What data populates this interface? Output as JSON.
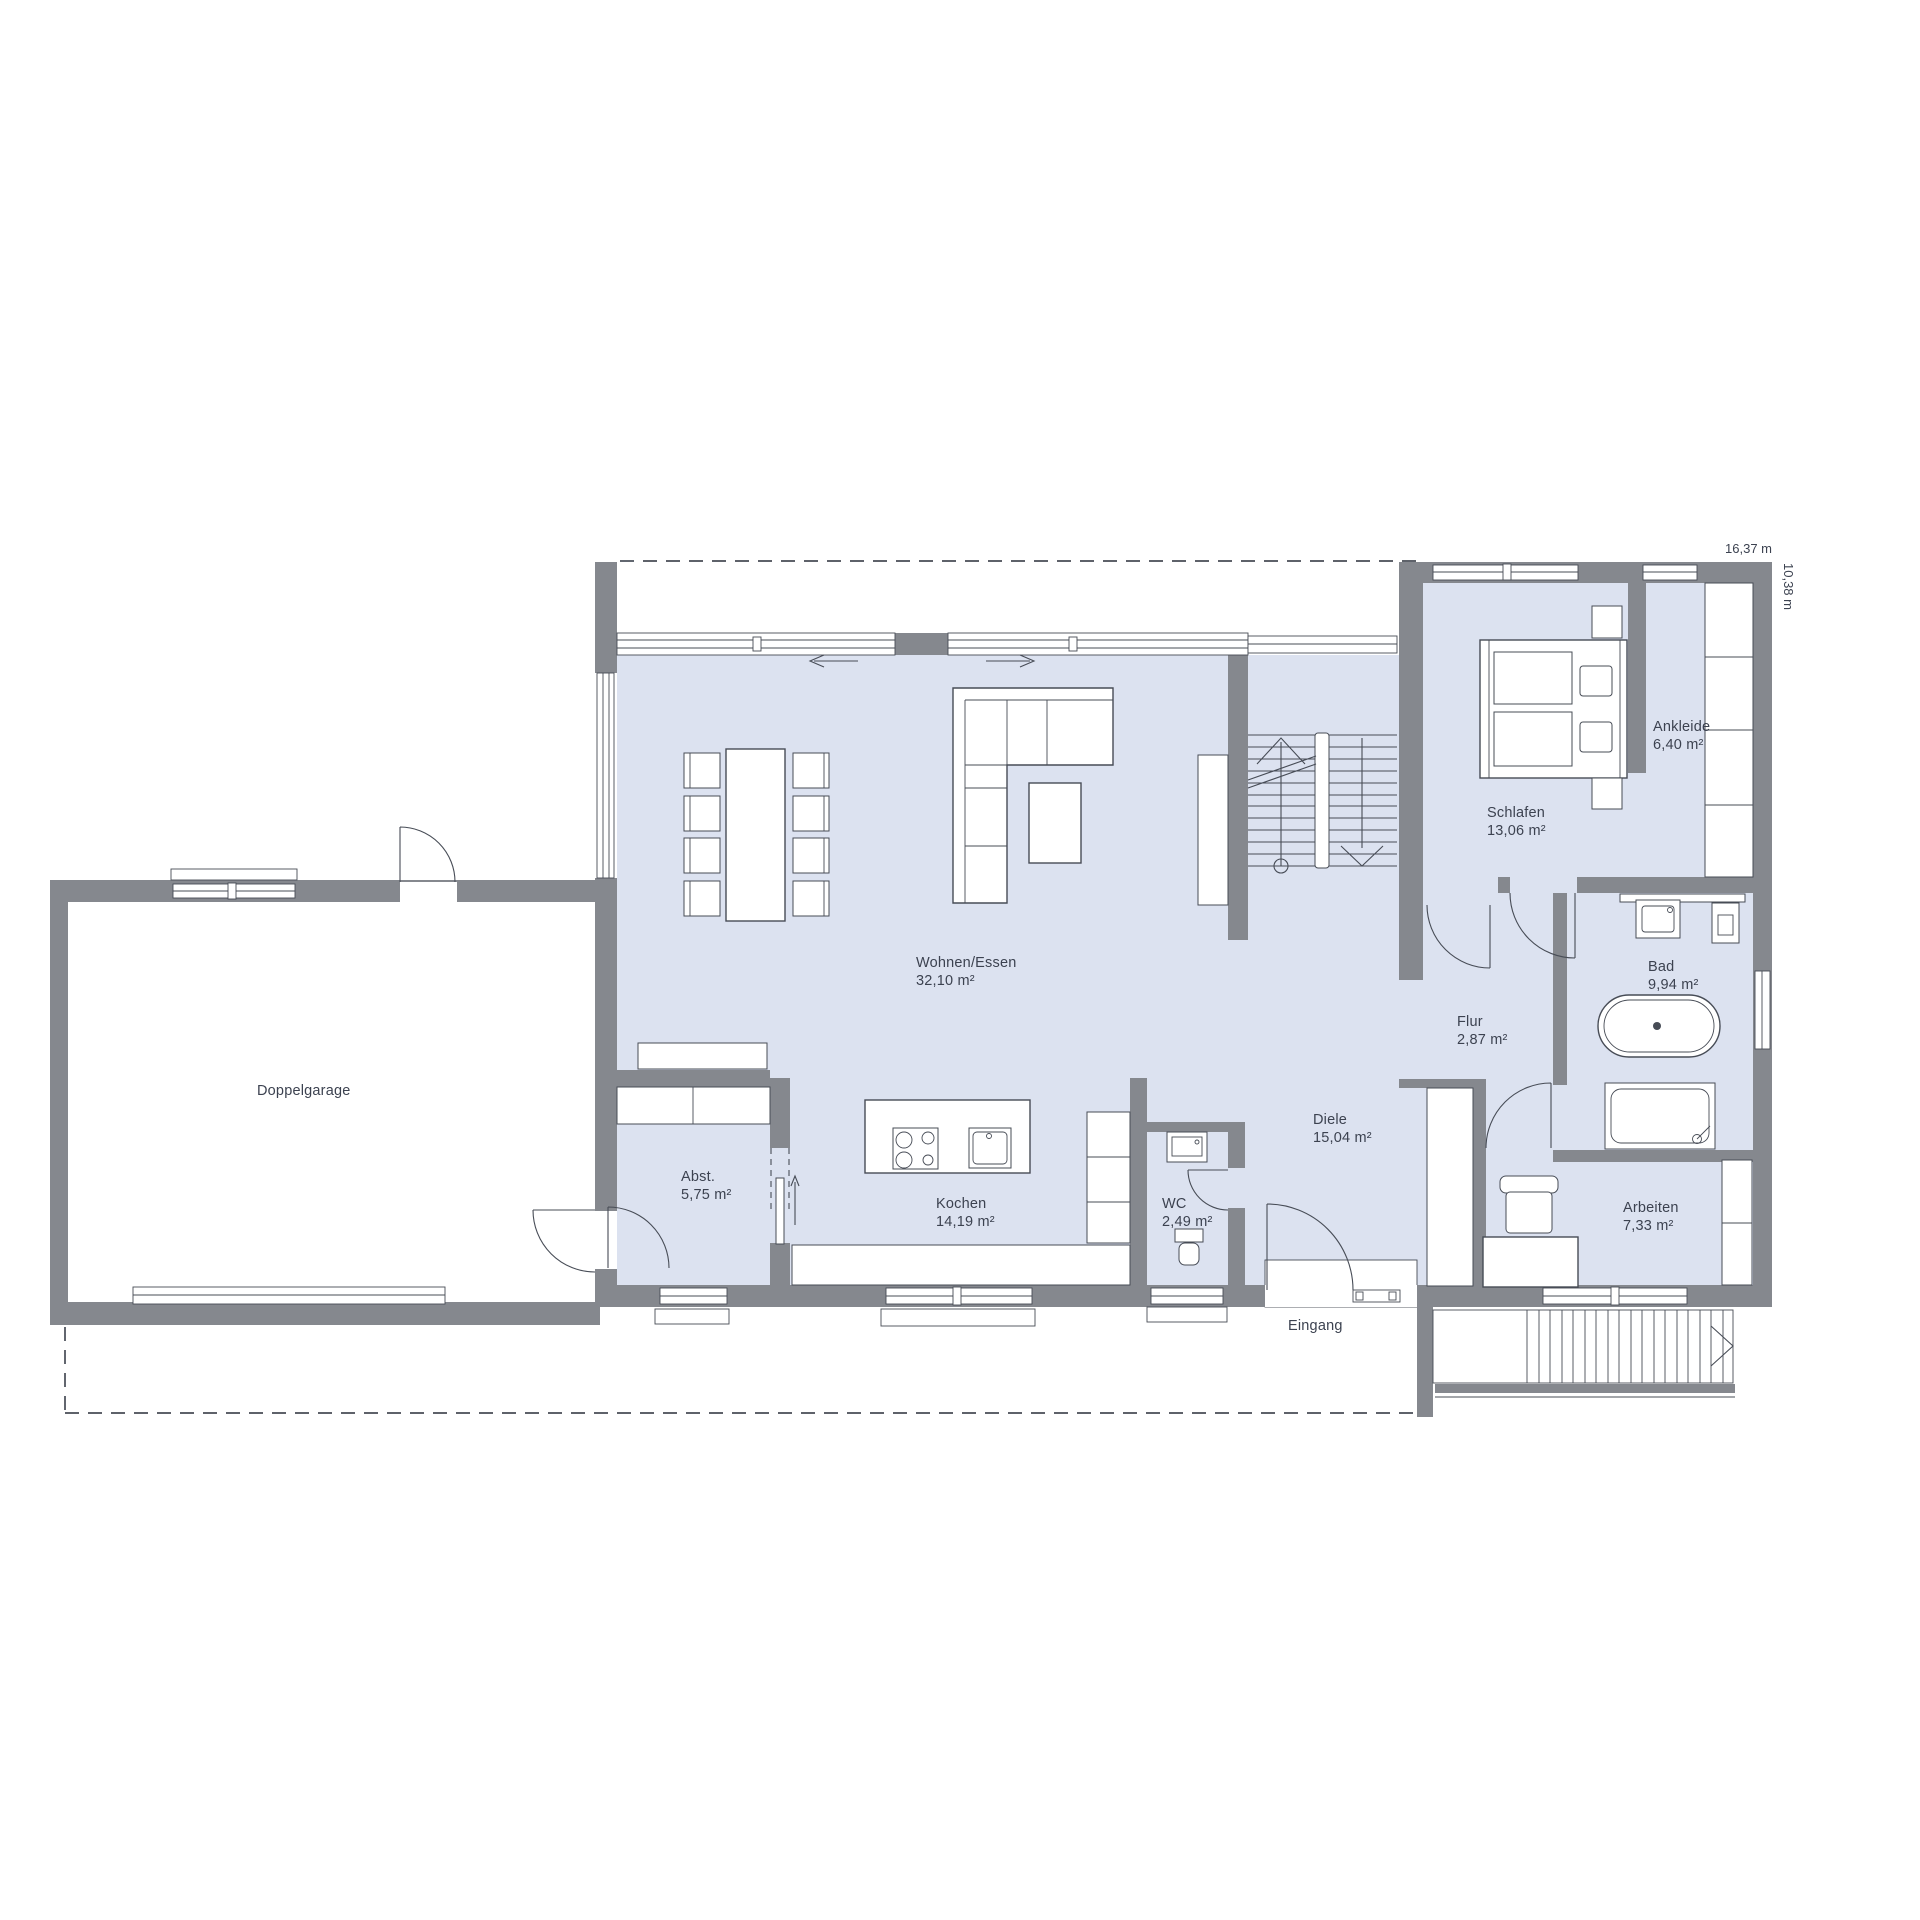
{
  "colors": {
    "wall": "#85888e",
    "floor": "#dce2f0",
    "line": "#474c56",
    "text": "#3c4250"
  },
  "dimensions": {
    "width_label": "16,37 m",
    "depth_label": "10,38 m"
  },
  "rooms": [
    {
      "id": "wohnen-essen",
      "name": "Wohnen/Essen",
      "area": "32,10 m²"
    },
    {
      "id": "kochen",
      "name": "Kochen",
      "area": "14,19 m²"
    },
    {
      "id": "abstellraum",
      "name": "Abst.",
      "area": "5,75 m²"
    },
    {
      "id": "wc",
      "name": "WC",
      "area": "2,49 m²"
    },
    {
      "id": "diele",
      "name": "Diele",
      "area": "15,04 m²"
    },
    {
      "id": "flur",
      "name": "Flur",
      "area": "2,87 m²"
    },
    {
      "id": "schlafen",
      "name": "Schlafen",
      "area": "13,06 m²"
    },
    {
      "id": "ankleide",
      "name": "Ankleide",
      "area": "6,40 m²"
    },
    {
      "id": "bad",
      "name": "Bad",
      "area": "9,94 m²"
    },
    {
      "id": "arbeiten",
      "name": "Arbeiten",
      "area": "7,33 m²"
    }
  ],
  "labels": {
    "garage": "Doppelgarage",
    "entrance": "Eingang"
  }
}
